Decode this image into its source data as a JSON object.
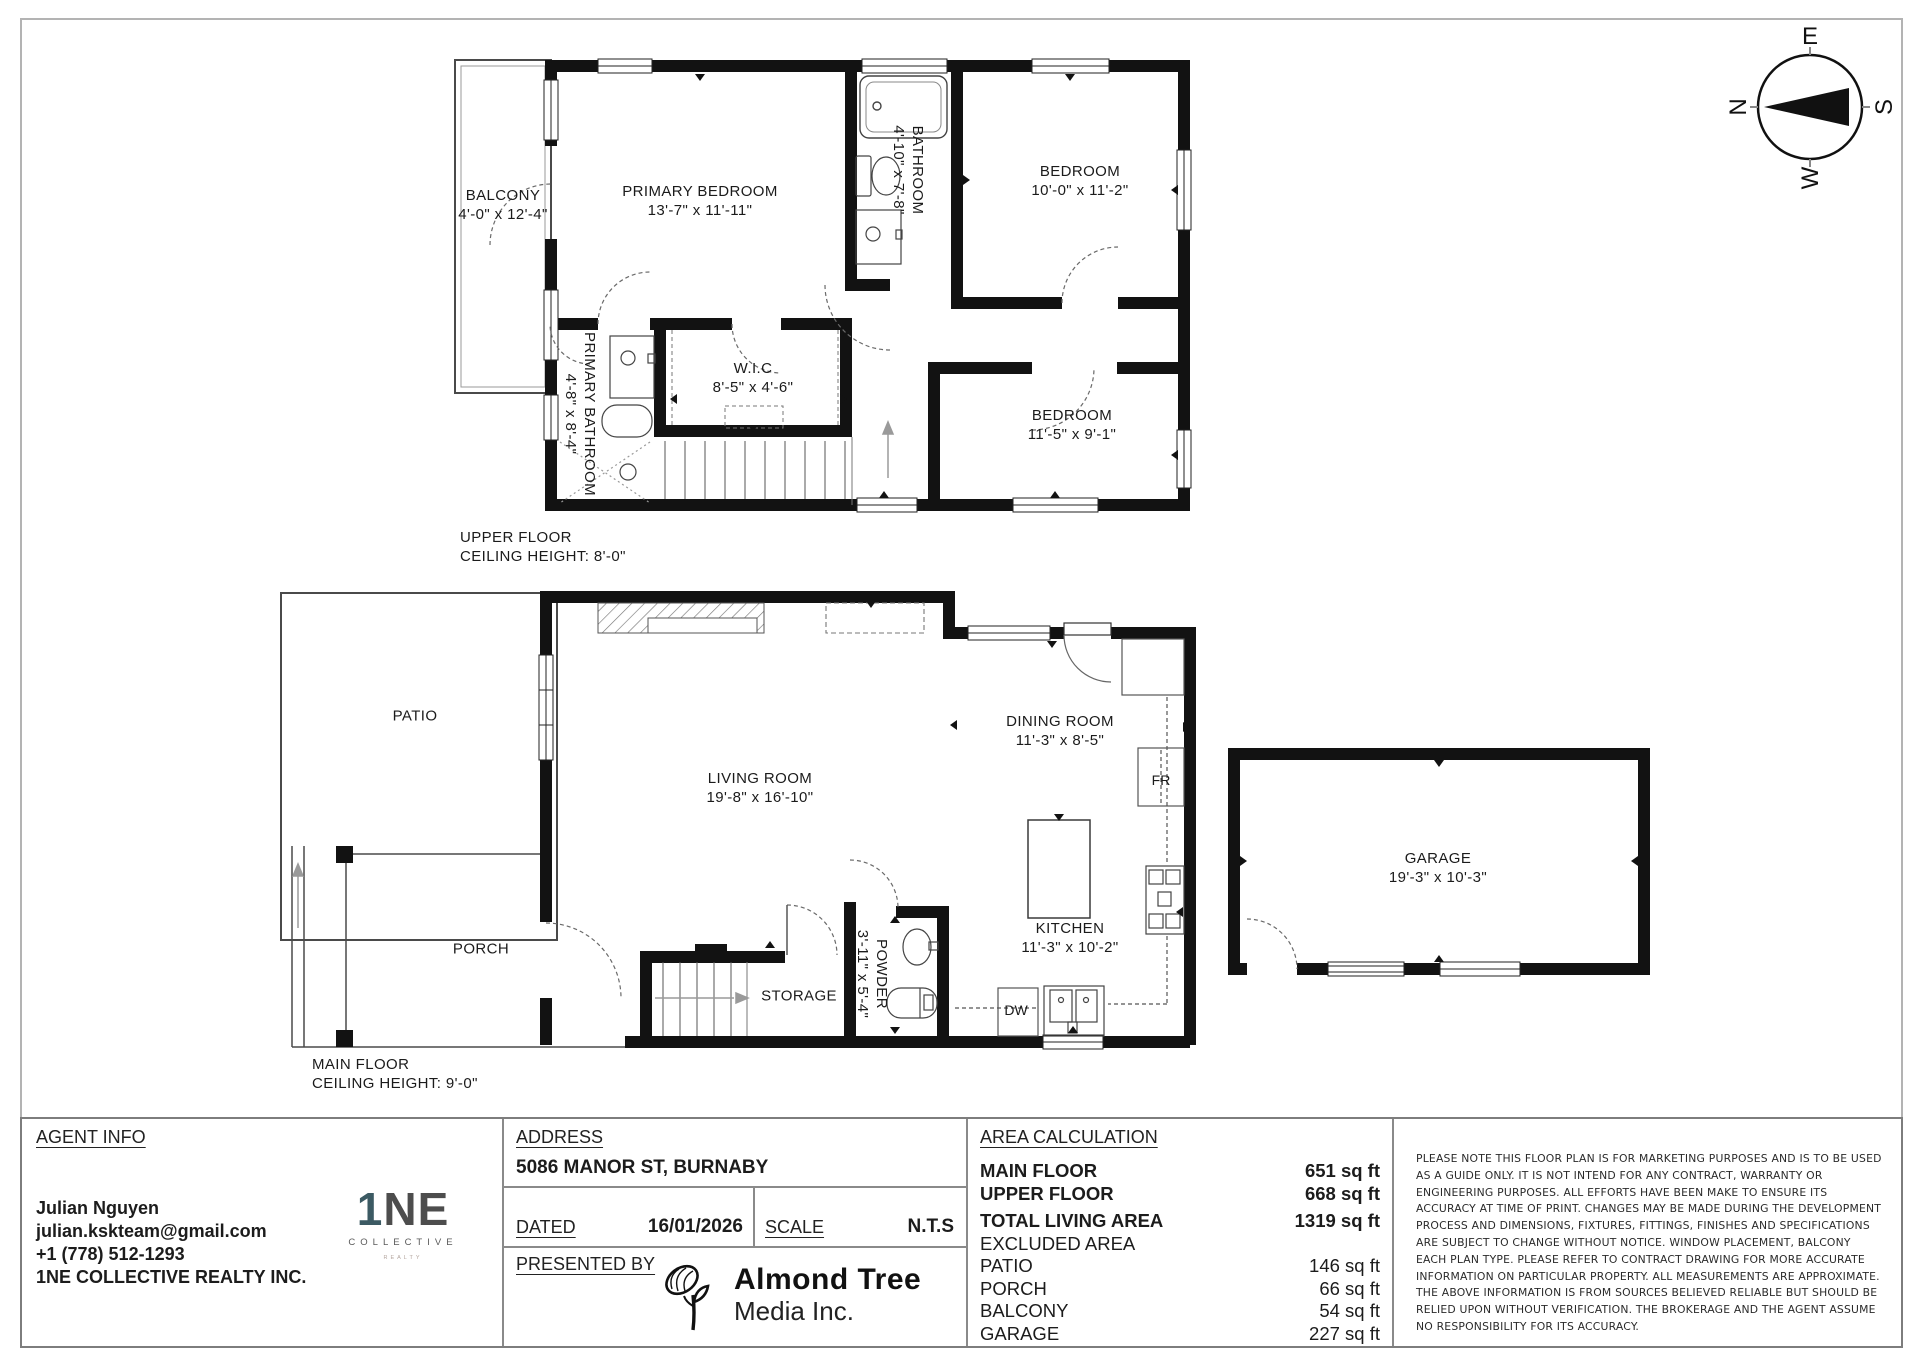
{
  "compass": {
    "n": "N",
    "e": "E",
    "s": "S",
    "w": "W"
  },
  "upper": {
    "title": "UPPER FLOOR",
    "ceiling": "CEILING HEIGHT: 8'-0\"",
    "balcony": {
      "name": "BALCONY",
      "dims": "4'-0\" x 12'-4\""
    },
    "primary_bedroom": {
      "name": "PRIMARY BEDROOM",
      "dims": "13'-7\" x 11'-11\""
    },
    "bathroom": {
      "name": "BATHROOM",
      "dims": "4'-10\" x 7'-8\""
    },
    "bedroom1": {
      "name": "BEDROOM",
      "dims": "10'-0\" x 11'-2\""
    },
    "wic": {
      "name": "W.I.C",
      "dims": "8'-5\" x 4'-6\""
    },
    "primary_bathroom": {
      "name": "PRIMARY BATHROOM",
      "dims": "4'-8\" x 8'-4\""
    },
    "bedroom2": {
      "name": "BEDROOM",
      "dims": "11'-5\" x 9'-1\""
    }
  },
  "main": {
    "title": "MAIN FLOOR",
    "ceiling": "CEILING HEIGHT: 9'-0\"",
    "patio": {
      "name": "PATIO"
    },
    "porch": {
      "name": "PORCH"
    },
    "living": {
      "name": "LIVING ROOM",
      "dims": "19'-8\" x 16'-10\""
    },
    "dining": {
      "name": "DINING ROOM",
      "dims": "11'-3\" x 8'-5\""
    },
    "kitchen": {
      "name": "KITCHEN",
      "dims": "11'-3\" x 10'-2\""
    },
    "storage": {
      "name": "STORAGE"
    },
    "powder": {
      "name": "POWDER",
      "dims": "3'-11\" x 5'-4\""
    },
    "garage": {
      "name": "GARAGE",
      "dims": "19'-3\" x 10'-3\""
    },
    "fridge": "FR",
    "dishwasher": "DW"
  },
  "footer": {
    "agent": {
      "heading": "AGENT INFO",
      "name": "Julian Nguyen",
      "email": "julian.kskteam@gmail.com",
      "phone": "+1 (778) 512-1293",
      "brokerage": "1NE COLLECTIVE REALTY INC."
    },
    "brokerage_logo": {
      "one": "1",
      "ne": "NE",
      "collective": "COLLECTIVE",
      "realty": "REALTY"
    },
    "address": {
      "heading": "ADDRESS",
      "value": "5086 MANOR ST, BURNABY"
    },
    "dated": {
      "label": "DATED",
      "value": "16/01/2026"
    },
    "scale": {
      "label": "SCALE",
      "value": "N.T.S"
    },
    "presented": {
      "label": "PRESENTED BY",
      "company_line1": "Almond Tree",
      "company_line2": "Media Inc."
    },
    "area": {
      "heading": "AREA CALCULATION",
      "rows": [
        {
          "label": "MAIN FLOOR",
          "value": "651 sq ft"
        },
        {
          "label": "UPPER FLOOR",
          "value": "668 sq ft"
        },
        {
          "label": "TOTAL LIVING AREA",
          "value": "1319 sq ft"
        },
        {
          "label": "EXCLUDED AREA",
          "value": ""
        },
        {
          "label": "PATIO",
          "value": "146 sq ft"
        },
        {
          "label": "PORCH",
          "value": "66 sq ft"
        },
        {
          "label": "BALCONY",
          "value": "54 sq ft"
        },
        {
          "label": "GARAGE",
          "value": "227 sq ft"
        }
      ]
    },
    "disclaimer": "PLEASE NOTE THIS FLOOR PLAN IS FOR MARKETING PURPOSES AND IS TO BE USED AS A GUIDE ONLY. IT IS NOT INTEND FOR ANY CONTRACT, WARRANTY OR ENGINEERING PURPOSES. ALL EFFORTS HAVE BEEN MAKE TO ENSURE ITS ACCURACY AT TIME OF PRINT. CHANGES MAY BE MADE DURING THE DEVELOPMENT PROCESS AND DIMENSIONS, FIXTURES, FITTINGS, FINISHES AND SPECIFICATIONS ARE SUBJECT TO CHANGE WITHOUT NOTICE. WINDOW PLACEMENT, BALCONY EACH PLAN TYPE. PLEASE REFER TO CONTRACT DRAWING FOR MORE ACCURATE INFORMATION ON PARTICULAR PROPERTY. ALL MEASUREMENTS ARE APPROXIMATE. THE ABOVE INFORMATION IS FROM SOURCES BELIEVED RELIABLE BUT SHOULD BE RELIED UPON WITHOUT VERIFICATION. THE BROKERAGE AND THE AGENT ASSUME NO RESPONSIBILITY FOR ITS ACCURACY."
  }
}
